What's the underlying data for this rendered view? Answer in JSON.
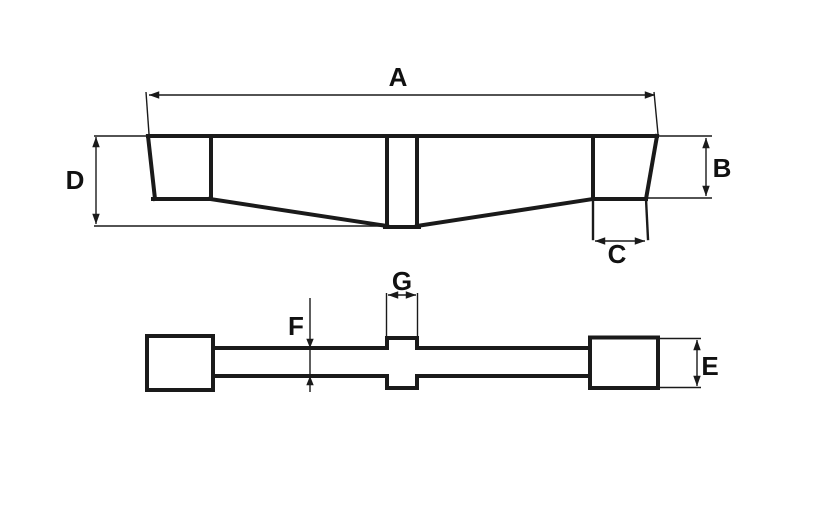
{
  "colors": {
    "background": "#ffffff",
    "line": "#1a1a1a",
    "text": "#111111"
  },
  "dims": {
    "a": {
      "label": "A",
      "measures": "overall-length-side-view"
    },
    "b": {
      "label": "B",
      "measures": "end-height-side-view"
    },
    "c": {
      "label": "C",
      "measures": "end-claw-width-side-view"
    },
    "d": {
      "label": "D",
      "measures": "total-height-at-center-side-view"
    },
    "e": {
      "label": "E",
      "measures": "end-block-height-plan-view"
    },
    "f": {
      "label": "F",
      "measures": "bar-thickness-plan-view"
    },
    "g": {
      "label": "G",
      "measures": "center-tab-width-plan-view"
    }
  }
}
